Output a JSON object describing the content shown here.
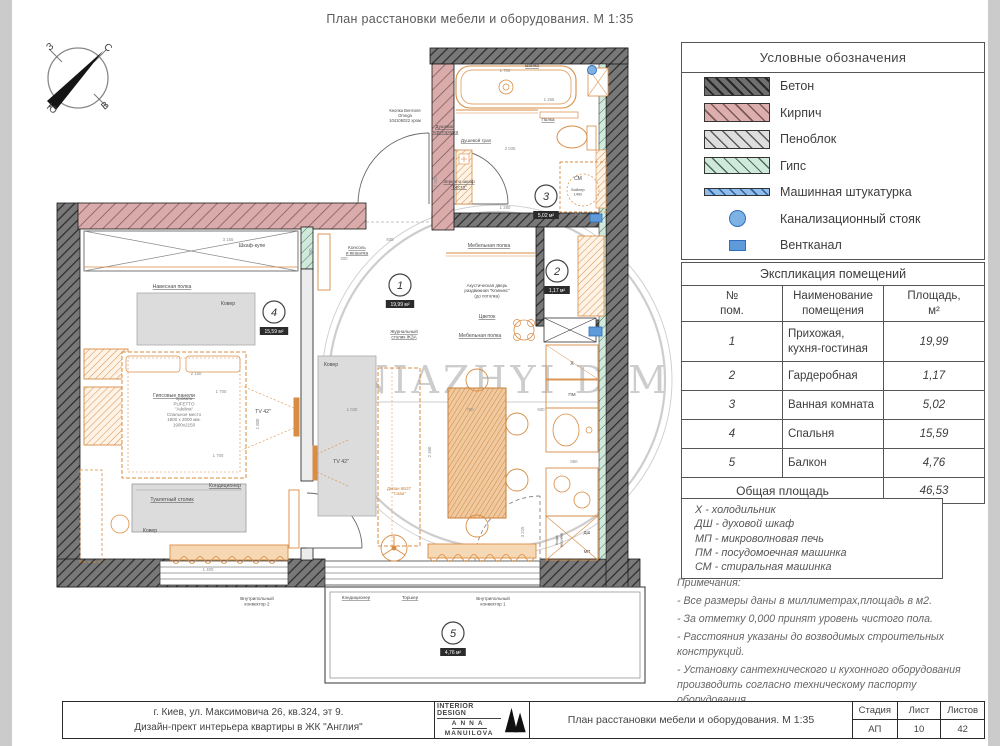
{
  "page": {
    "title": "План расстановки мебели и оборудования.  М 1:35"
  },
  "compass": {
    "n": "С",
    "w": "З",
    "e": "В",
    "s": "Ю"
  },
  "watermark": {
    "text": "KNIAZHYI DIM"
  },
  "legend": {
    "title": "Условные обозначения",
    "items": [
      {
        "kind": "concrete",
        "icon": "concrete-hatch-swatch",
        "label": "Бетон",
        "color": "#6f6f6f"
      },
      {
        "kind": "brick",
        "icon": "brick-hatch-swatch",
        "label": "Кирпич",
        "color": "#dcaeae"
      },
      {
        "kind": "foam",
        "icon": "foamblock-hatch-swatch",
        "label": "Пеноблок",
        "color": "#dedede"
      },
      {
        "kind": "gypsum",
        "icon": "gypsum-hatch-swatch",
        "label": "Гипс",
        "color": "#cfe9db"
      },
      {
        "kind": "plaster",
        "icon": "machine-plaster-swatch",
        "label": "Машинная штукатурка",
        "color": "#8fbce8"
      },
      {
        "kind": "riser",
        "icon": "sewer-riser-circle-icon",
        "label": "Канализационный стояк",
        "color": "#7fb2e4"
      },
      {
        "kind": "vent",
        "icon": "vent-channel-icon",
        "label": "Вентканал",
        "color": "#5f9bd8"
      }
    ]
  },
  "rooms_table": {
    "title": "Экспликация помещений",
    "col_num": "№\nпом.",
    "col_name": "Наименование\nпомещения",
    "col_area": "Площадь,\nм²",
    "rows": [
      {
        "num": "1",
        "name": "Прихожая,\nкухня-гостиная",
        "area": "19,99"
      },
      {
        "num": "2",
        "name": "Гардеробная",
        "area": "1,17"
      },
      {
        "num": "3",
        "name": "Ванная комната",
        "area": "5,02"
      },
      {
        "num": "4",
        "name": "Спальня",
        "area": "15,59"
      },
      {
        "num": "5",
        "name": "Балкон",
        "area": "4,76"
      }
    ],
    "total_label": "Общая площадь",
    "total_value": "46,53"
  },
  "abbreviations": [
    "Х - холодильник",
    "ДШ - духовой шкаф",
    "МП - микроволновая печь",
    "ПМ - посудомоечная машинка",
    "СМ - стиральная машинка"
  ],
  "notes": {
    "title": "Примечания:",
    "items": [
      "- Все размеры даны в миллиметрах,площадь в м2.",
      "- За отметку 0,000 принят уровень чистого пола.",
      "- Расстояния указаны до возводимых строительных конструкций.",
      "- Установку сантехнического и кухонного оборудования производить согласно техническому паспорту оборудования.",
      "- Детальный план расположения отопления и кондиционирования см. лист 12."
    ]
  },
  "titleblock": {
    "address_line1": "г. Киев, ул. Максимовича 26, кв.324, эт 9.",
    "address_line2": "Дизайн-прект интерьера квартиры в ЖК \"Англия\"",
    "logo_line1": "INTERIOR DESIGN",
    "logo_line2": "ANNA",
    "logo_line3": "MANUILOVA",
    "drawing_title": "План расстановки мебели и оборудования.  М 1:35",
    "stage_label": "Стадия",
    "sheet_label": "Лист",
    "sheets_label": "Листов",
    "stage": "АП",
    "sheet": "10",
    "sheets": "42"
  },
  "plan": {
    "rooms": [
      {
        "n": "1",
        "x": 400,
        "y": 285,
        "area": "19,99 м²"
      },
      {
        "n": "2",
        "x": 557,
        "y": 271,
        "area": "1,17 м²"
      },
      {
        "n": "3",
        "x": 546,
        "y": 196,
        "area": "5,02 м²"
      },
      {
        "n": "4",
        "x": 274,
        "y": 312,
        "area": "15,59 м²"
      },
      {
        "n": "5",
        "x": 453,
        "y": 633,
        "area": "4,76 м²"
      }
    ],
    "texts": [
      {
        "t": "Шкаф-купе",
        "x": 252,
        "y": 247
      },
      {
        "t": "Навесная полка",
        "x": 172,
        "y": 288,
        "u": 1
      },
      {
        "t": "Ковер",
        "x": 228,
        "y": 305
      },
      {
        "t": "Гипсовые панели",
        "x": 174,
        "y": 397,
        "u": 1
      },
      {
        "t": "Кровать\nPUFETTO\n\"Adelina\"\nСпальное место\n1800 х 2000 мм.\n1900х2150",
        "x": 184,
        "y": 400,
        "s": 4.5,
        "c": "#777777"
      },
      {
        "t": "ТV 42\"",
        "x": 263,
        "y": 413
      },
      {
        "t": "Туалетный столик",
        "x": 172,
        "y": 501,
        "u": 1
      },
      {
        "t": "Кондиционер",
        "x": 225,
        "y": 487,
        "u": 1
      },
      {
        "t": "Ковер",
        "x": 150,
        "y": 532
      },
      {
        "t": "Внутрипольный\nконвектор 2",
        "x": 257,
        "y": 600,
        "s": 4.6
      },
      {
        "t": "Кондиционер",
        "x": 356,
        "y": 599,
        "s": 4.6,
        "u": 1
      },
      {
        "t": "Торшер",
        "x": 410,
        "y": 599,
        "s": 4.6,
        "u": 1
      },
      {
        "t": "Внутрипольный\nконвектор 1",
        "x": 493,
        "y": 600,
        "s": 4.6
      },
      {
        "t": "TV 42\"",
        "x": 341,
        "y": 463
      },
      {
        "t": "Ковер",
        "x": 331,
        "y": 366
      },
      {
        "t": "Диван 6Б37\n\"Сава\"",
        "x": 399,
        "y": 490,
        "s": 4.4,
        "c": "#c87f3a"
      },
      {
        "t": "Журнальный\nстолик ЖЗА",
        "x": 404,
        "y": 333,
        "s": 4.6,
        "u": 1
      },
      {
        "t": "Мебельная полка",
        "x": 480,
        "y": 337,
        "u": 1
      },
      {
        "t": "Цветок",
        "x": 487,
        "y": 318,
        "u": 1
      },
      {
        "t": "Акустическая дверь\nраздвижная \"Клиникс\"\n(до потолка)",
        "x": 487,
        "y": 287,
        "s": 4.4
      },
      {
        "t": "Мебельная полка",
        "x": 489,
        "y": 247,
        "u": 1
      },
      {
        "t": "Консоль\nи вешалка",
        "x": 357,
        "y": 249,
        "s": 4.6,
        "u": 1
      },
      {
        "t": "Кнопка Вентиля\nOmega\n104106022 хром",
        "x": 405,
        "y": 112,
        "s": 4.2
      },
      {
        "t": "Ванна",
        "x": 532,
        "y": 67,
        "s": 4.8,
        "u": 1
      },
      {
        "t": "Душевая\nперегородка",
        "x": 445,
        "y": 128,
        "s": 4.6,
        "u": 1
      },
      {
        "t": "Полка",
        "x": 548,
        "y": 121,
        "s": 4.6,
        "u": 1
      },
      {
        "t": "Душевой трап",
        "x": 476,
        "y": 142,
        "s": 4.6,
        "u": 1
      },
      {
        "t": "Зеркало шкаф\n\"Бесто\"",
        "x": 459,
        "y": 183,
        "s": 4.6,
        "u": 1
      },
      {
        "t": "СМ",
        "x": 578,
        "y": 180,
        "s": 5
      },
      {
        "t": "Бойлер\n140л",
        "x": 578,
        "y": 191,
        "s": 3.8
      },
      {
        "t": "Х",
        "x": 572,
        "y": 365,
        "s": 5.5
      },
      {
        "t": "ПМ",
        "x": 572,
        "y": 396,
        "s": 4.6
      },
      {
        "t": "ДШ",
        "x": 587,
        "y": 534,
        "s": 4.2
      },
      {
        "t": "МП",
        "x": 587,
        "y": 553,
        "s": 4.2
      },
      {
        "t": "Кофе\nмашина",
        "x": 558,
        "y": 540,
        "s": 3.8,
        "r": -90
      }
    ],
    "dims": [
      {
        "t": "3 155",
        "x": 228,
        "y": 241
      },
      {
        "t": "935",
        "x": 390,
        "y": 241
      },
      {
        "t": "400",
        "x": 344,
        "y": 260
      },
      {
        "t": "750",
        "x": 312,
        "y": 252,
        "r": -90
      },
      {
        "t": "1 700",
        "x": 505,
        "y": 72
      },
      {
        "t": "1 265",
        "x": 549,
        "y": 101
      },
      {
        "t": "2 035",
        "x": 510,
        "y": 150
      },
      {
        "t": "1 280",
        "x": 505,
        "y": 209
      },
      {
        "t": "600",
        "x": 578,
        "y": 216
      },
      {
        "t": "2 203",
        "x": 437,
        "y": 182,
        "r": -90
      },
      {
        "t": "2 150",
        "x": 196,
        "y": 375
      },
      {
        "t": "1 700",
        "x": 221,
        "y": 393
      },
      {
        "t": "1 700",
        "x": 218,
        "y": 457
      },
      {
        "t": "1 400",
        "x": 208,
        "y": 571
      },
      {
        "t": "1 800",
        "x": 259,
        "y": 424,
        "r": -90
      },
      {
        "t": "1 030",
        "x": 352,
        "y": 411
      },
      {
        "t": "760",
        "x": 470,
        "y": 411
      },
      {
        "t": "930",
        "x": 541,
        "y": 411
      },
      {
        "t": "2 460",
        "x": 431,
        "y": 452,
        "r": -90
      },
      {
        "t": "3 225",
        "x": 524,
        "y": 532,
        "r": -90
      },
      {
        "t": "550",
        "x": 574,
        "y": 463
      }
    ]
  }
}
